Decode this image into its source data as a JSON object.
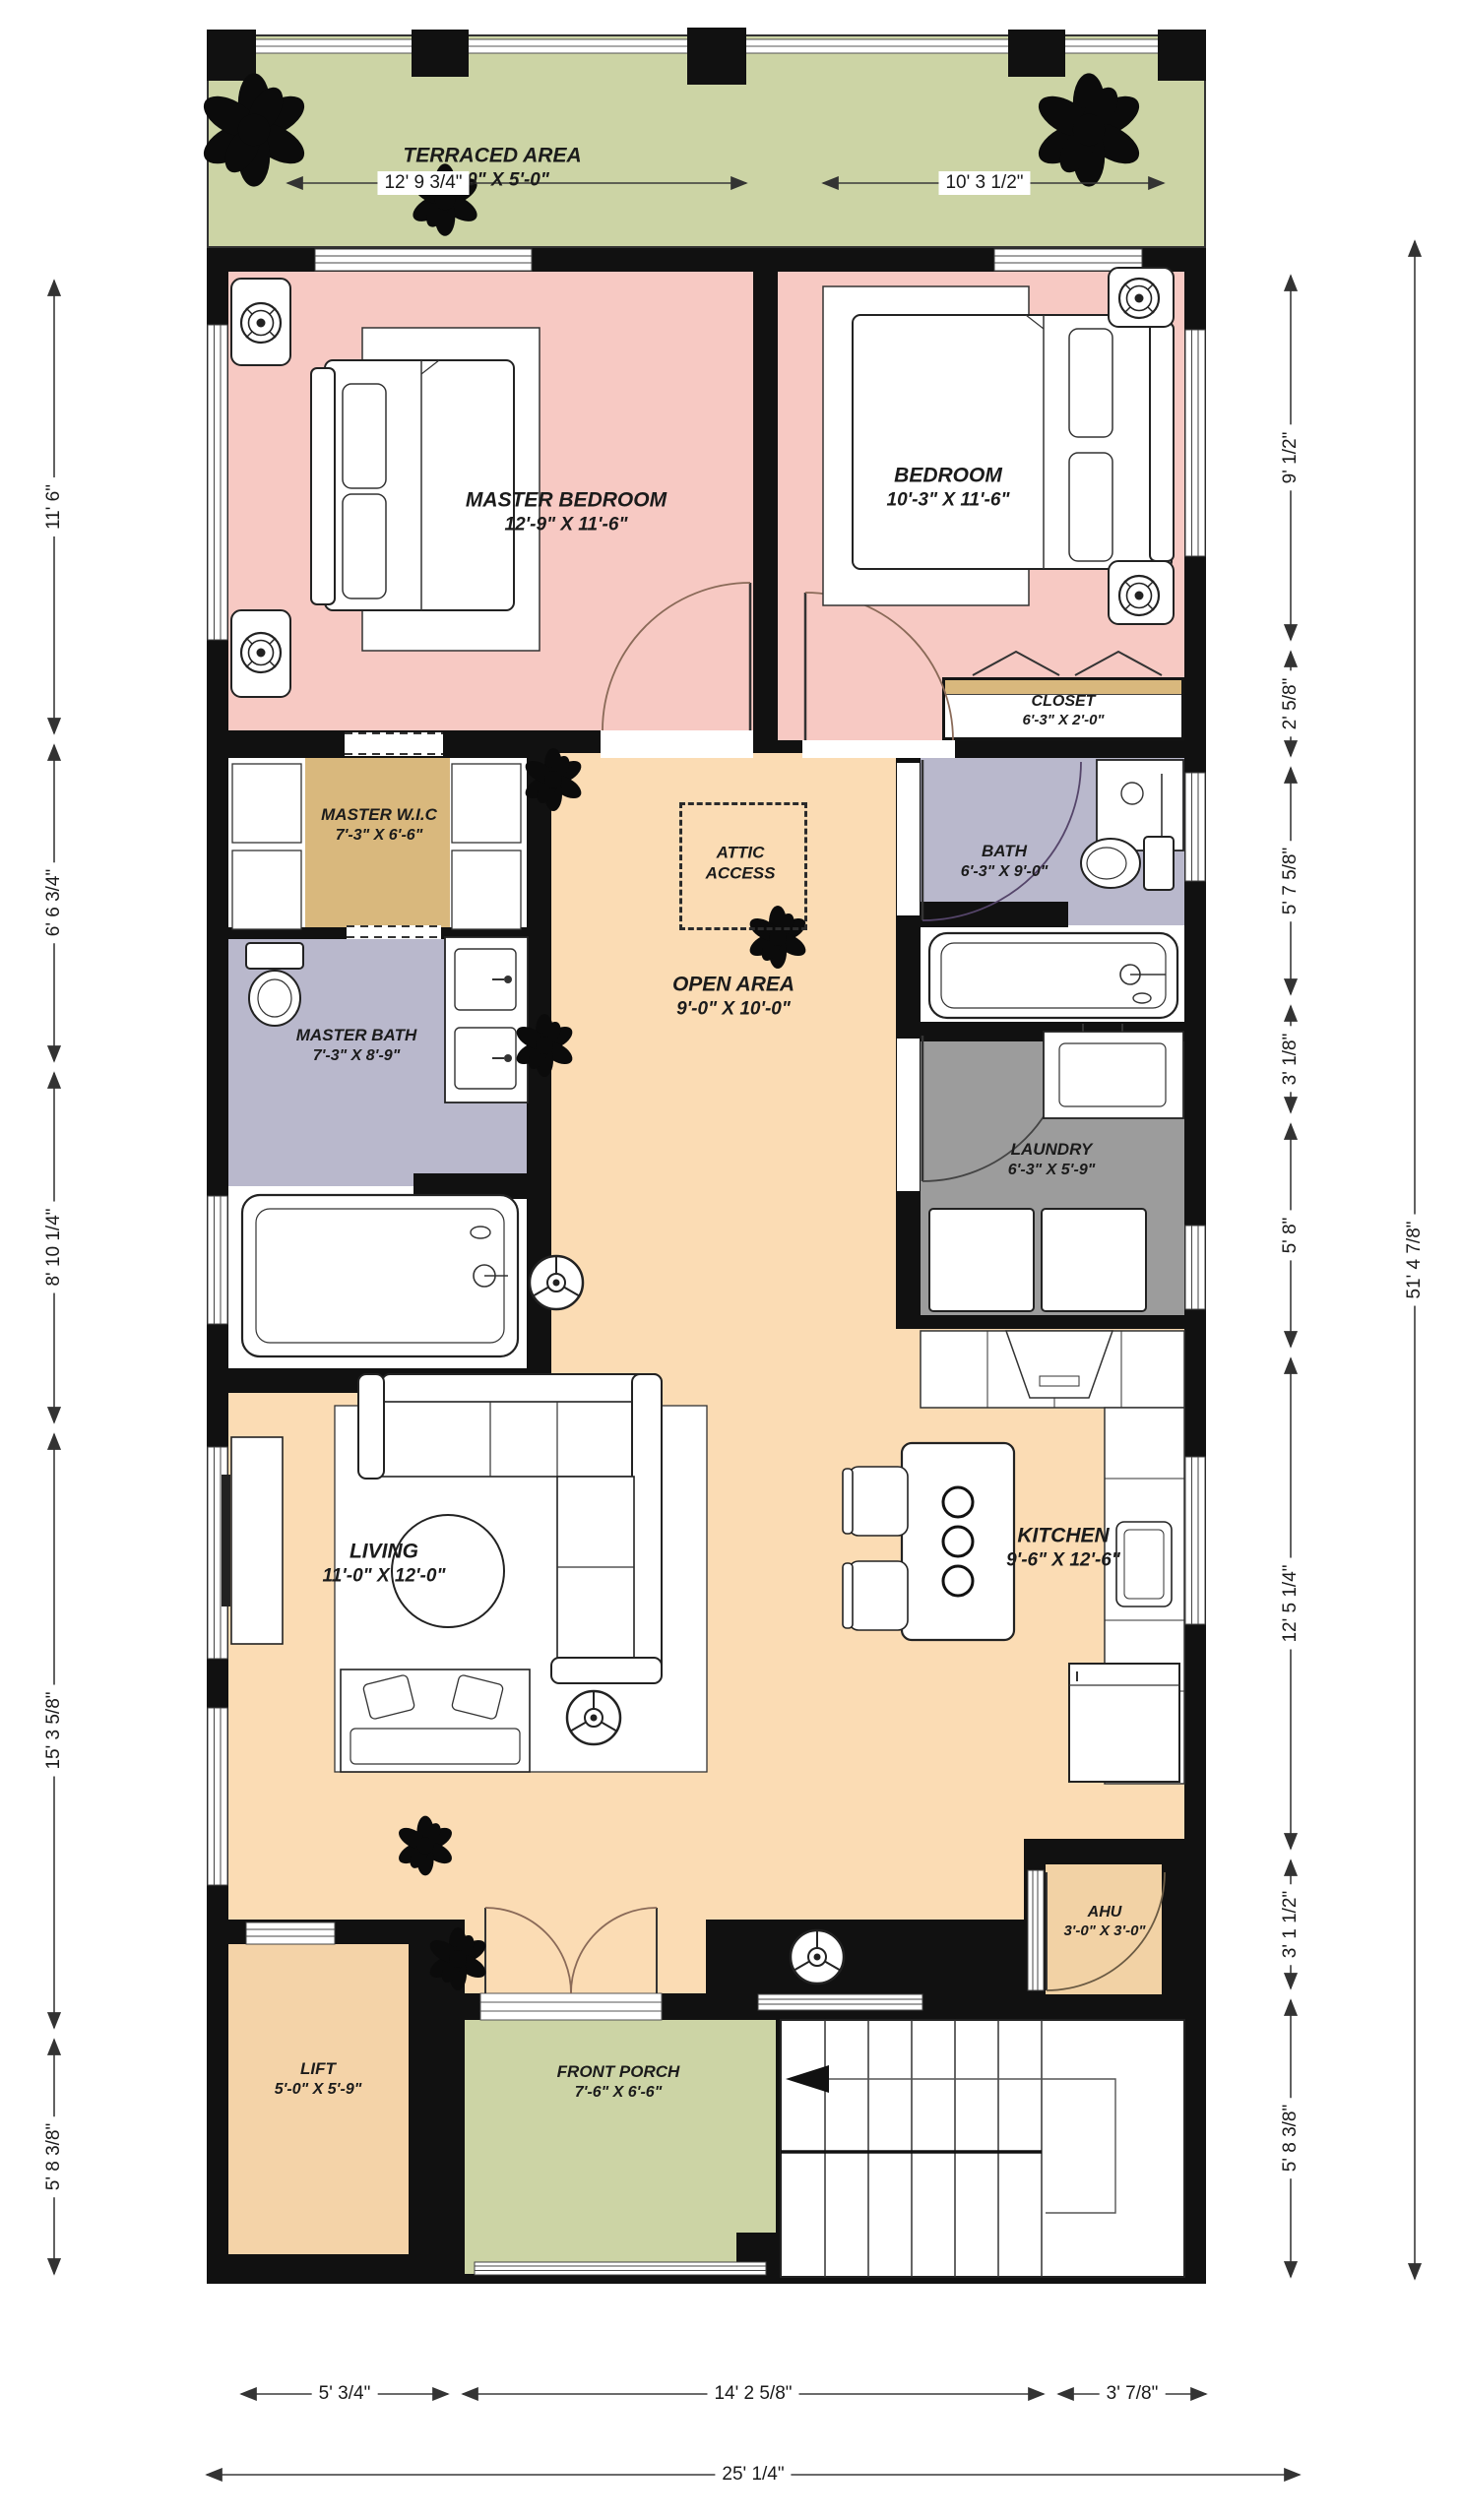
{
  "rooms": {
    "terrace": {
      "name": "TERRACED AREA",
      "size": "25'-0\" X 5'-0\""
    },
    "master_bedroom": {
      "name": "MASTER BEDROOM",
      "size": "12'-9\" X 11'-6\""
    },
    "bedroom": {
      "name": "BEDROOM",
      "size": "10'-3\" X 11'-6\""
    },
    "closet": {
      "name": "CLOSET",
      "size": "6'-3\" X 2'-0\""
    },
    "master_wic": {
      "name": "MASTER W.I.C",
      "size": "7'-3\" X 6'-6\""
    },
    "attic": {
      "name": "ATTIC ACCESS"
    },
    "open_area": {
      "name": "OPEN AREA",
      "size": "9'-0\" X 10'-0\""
    },
    "master_bath": {
      "name": "MASTER BATH",
      "size": "7'-3\" X 8'-9\""
    },
    "bath": {
      "name": "BATH",
      "size": "6'-3\" X 9'-0\""
    },
    "laundry": {
      "name": "LAUNDRY",
      "size": "6'-3\" X 5'-9\""
    },
    "living": {
      "name": "LIVING",
      "size": "11'-0\" X 12'-0\""
    },
    "kitchen": {
      "name": "KITCHEN",
      "size": "9'-6\" X 12'-6\""
    },
    "ahu": {
      "name": "AHU",
      "size": "3'-0\" X 3'-0\""
    },
    "lift": {
      "name": "LIFT",
      "size": "5'-0\" X 5'-9\""
    },
    "front_porch": {
      "name": "FRONT PORCH",
      "size": "7'-6\" X 6'-6\""
    }
  },
  "dimensions": {
    "top": [
      "12' 9 3/4\"",
      "10' 3 1/2\""
    ],
    "left": [
      "11' 6\"",
      "6' 6 3/4\"",
      "8' 10 1/4\"",
      "15' 3 5/8\"",
      "5' 8 3/8\""
    ],
    "right": [
      "9' 1/2\"",
      "2' 5/8\"",
      "5' 7 5/8\"",
      "3' 1/8\"",
      "5' 8\"",
      "12' 5 1/4\"",
      "3' 1 1/2\"",
      "5' 8 3/8\""
    ],
    "right_overall": "51' 4 7/8\"",
    "bottom": [
      "5' 3/4\"",
      "14' 2 5/8\"",
      "3' 7/8\""
    ],
    "bottom_overall": "25' 1/4\""
  },
  "colors": {
    "wall": "#111111",
    "bedroom_pink": "#f7c9c3",
    "floor_peach": "#fbdcb4",
    "terrace_green": "#ccd4a5",
    "porch_green": "#ccd4a5",
    "bath_lavender": "#b9b8cc",
    "wic_tan": "#d9b87d",
    "laundry_gray": "#9c9c9c",
    "utility_tan": "#f2d2a5"
  }
}
